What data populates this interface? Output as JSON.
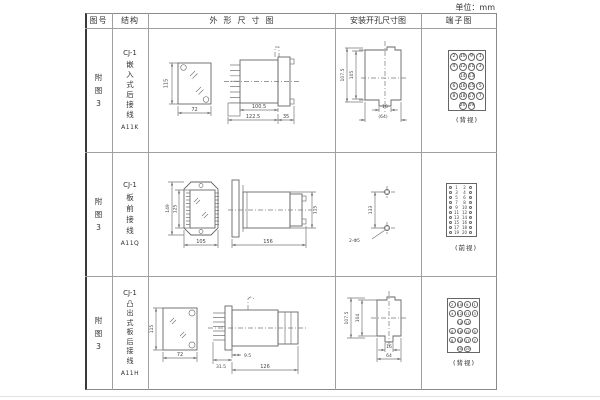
{
  "unit_label": "单位：mm",
  "colors": {
    "line": "#777777",
    "text": "#333333",
    "grid": "#a0a0a0"
  },
  "headers": {
    "fig_no": "图号",
    "structure": "结构",
    "outline": "外形尺寸图",
    "install": "安装开孔尺寸图",
    "terminal": "端子图"
  },
  "rows": [
    {
      "fig_no": "附图3",
      "model": "CJ-1",
      "mount": "嵌入式后接线",
      "code": "A11K",
      "outline": {
        "front_h": "115",
        "front_w": "72",
        "side_d1": "100.5",
        "side_d2": "122.5",
        "side_d3": "35"
      },
      "install": {
        "v_outer": "107.5",
        "v_inner": "105",
        "h_inner": "16",
        "h_outer": "(64)"
      },
      "terminal": {
        "caption": "(背视)",
        "grid": [
          [
            "2",
            "10",
            "9",
            "1"
          ],
          [
            "4",
            "12",
            "11",
            "3"
          ],
          [
            "",
            "14",
            "13",
            ""
          ],
          [
            "6",
            "16",
            "15",
            "5"
          ],
          [
            "8",
            "18",
            "17",
            "7"
          ],
          [
            "",
            "20",
            "19",
            ""
          ]
        ]
      }
    },
    {
      "fig_no": "附图3",
      "model": "CJ-1",
      "mount": "板前接线",
      "code": "A11Q",
      "outline": {
        "front_h1": "149",
        "front_h2": "125",
        "front_w": "105",
        "side_d1": "156",
        "side_h": "115"
      },
      "install": {
        "v": "133",
        "hole_label": "2-Φ5"
      },
      "terminal": {
        "caption": "(前视)",
        "left": [
          "1",
          "3",
          "5",
          "7",
          "9",
          "11",
          "13",
          "15",
          "17",
          "19"
        ],
        "right": [
          "2",
          "4",
          "6",
          "8",
          "10",
          "12",
          "14",
          "16",
          "18",
          "20"
        ]
      }
    },
    {
      "fig_no": "附图3",
      "model": "CJ-1",
      "mount": "凸出式板后接线",
      "code": "A11H",
      "outline": {
        "front_h": "115",
        "front_w": "72",
        "side_d1": "31.5",
        "side_d2": "9.5",
        "side_d3": "126"
      },
      "install": {
        "v_outer": "107.5",
        "v_inner": "104",
        "h_inner": "16",
        "h_outer": "64"
      },
      "terminal": {
        "caption": "(背视)",
        "grid": [
          [
            "2",
            "10",
            "9",
            "1"
          ],
          [
            "4",
            "12",
            "11",
            "3"
          ],
          [
            "",
            "14",
            "13",
            ""
          ],
          [
            "6",
            "16",
            "15",
            "5"
          ],
          [
            "8",
            "18",
            "17",
            "7"
          ],
          [
            "",
            "20",
            "19",
            ""
          ]
        ]
      }
    }
  ]
}
